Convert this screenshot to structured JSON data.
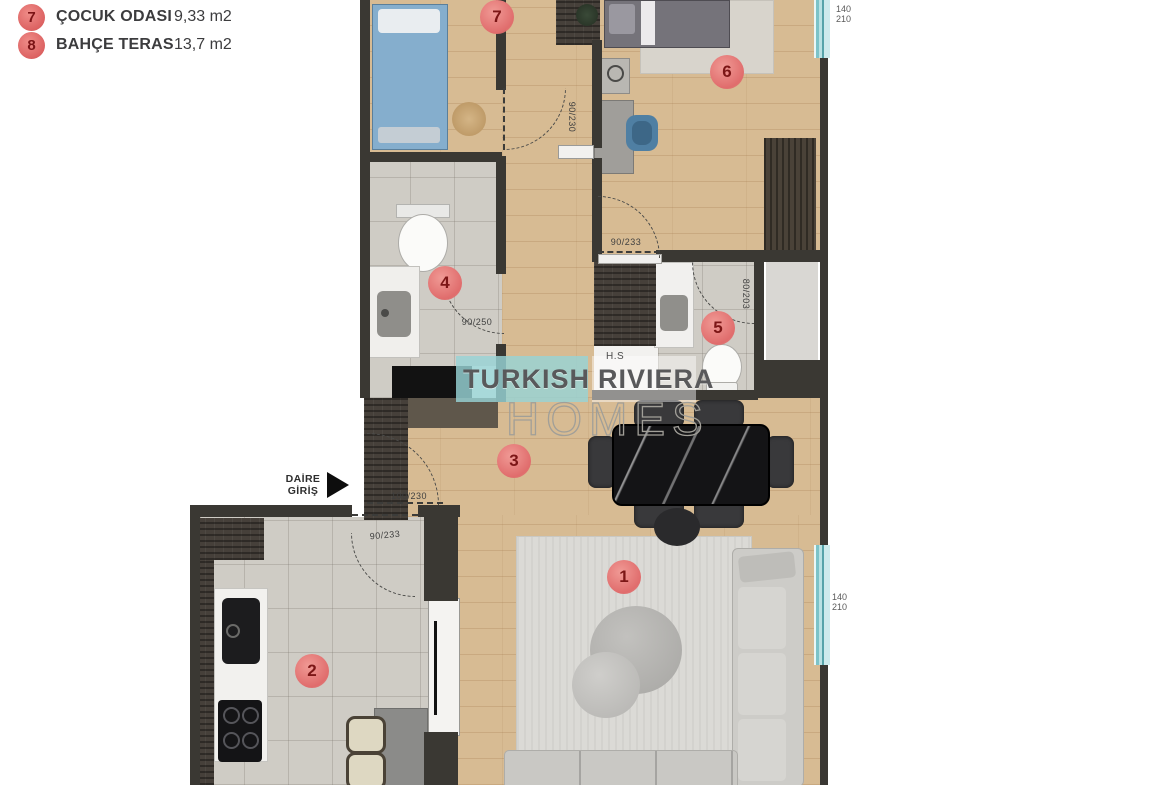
{
  "legend": {
    "items": [
      {
        "number": "7",
        "label": "ÇOCUK ODASI",
        "area": "9,33 m2"
      },
      {
        "number": "8",
        "label": "BAHÇE TERAS",
        "area": "13,7 m2"
      }
    ]
  },
  "entrance": {
    "line1": "DAİRE",
    "line2": "GİRİŞ"
  },
  "watermark": {
    "word1": "TURKISH",
    "word2": "RIVIERA",
    "word3": "HOMES"
  },
  "room_markers": [
    {
      "number": "1"
    },
    {
      "number": "2"
    },
    {
      "number": "3"
    },
    {
      "number": "4"
    },
    {
      "number": "5"
    },
    {
      "number": "6"
    },
    {
      "number": "7"
    }
  ],
  "dimension_labels": [
    {
      "text": "90/230"
    },
    {
      "text": "90/233"
    },
    {
      "text": "90/250"
    },
    {
      "text": "80/203"
    },
    {
      "text": "100/230"
    },
    {
      "text": "90/233"
    }
  ],
  "window_labels": [
    {
      "width": "140",
      "height": "210"
    },
    {
      "width": "140",
      "height": "210"
    }
  ],
  "room_labels": {
    "hs": "H.S"
  },
  "colors": {
    "marker_red": "#e06c6c",
    "window_teal": "#8fd0d4",
    "wall_dark": "#3a3833",
    "wood_floor": "#d7bb93",
    "tile_gray": "#cfccc5",
    "watermark_teal": "#97d3d6"
  }
}
